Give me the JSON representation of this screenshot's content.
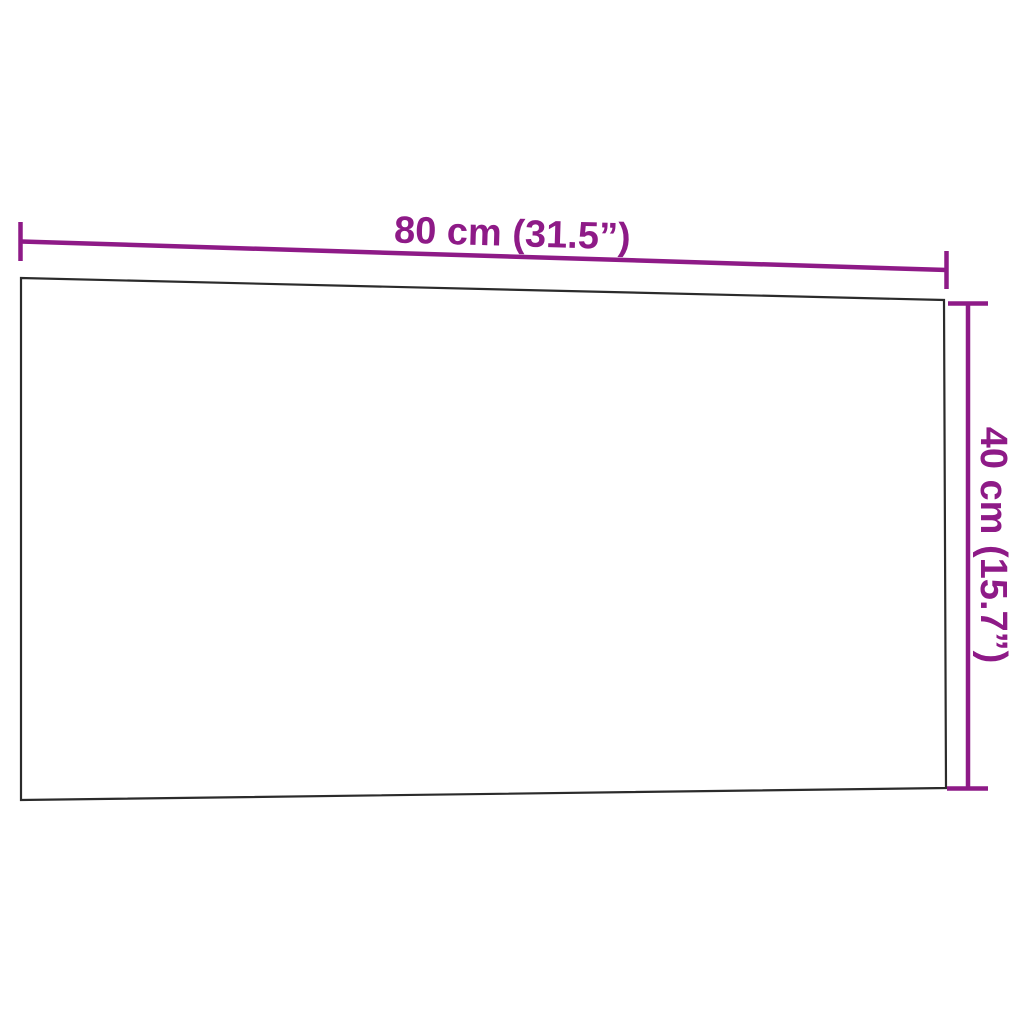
{
  "diagram": {
    "width_dimension": {
      "label": "80 cm (31.5”)"
    },
    "height_dimension": {
      "label": "40 cm (15.7”)"
    },
    "colors": {
      "dimension_accent": "#8e1a87",
      "panel_outline": "#2b2b2b",
      "background": "#ffffff"
    }
  }
}
